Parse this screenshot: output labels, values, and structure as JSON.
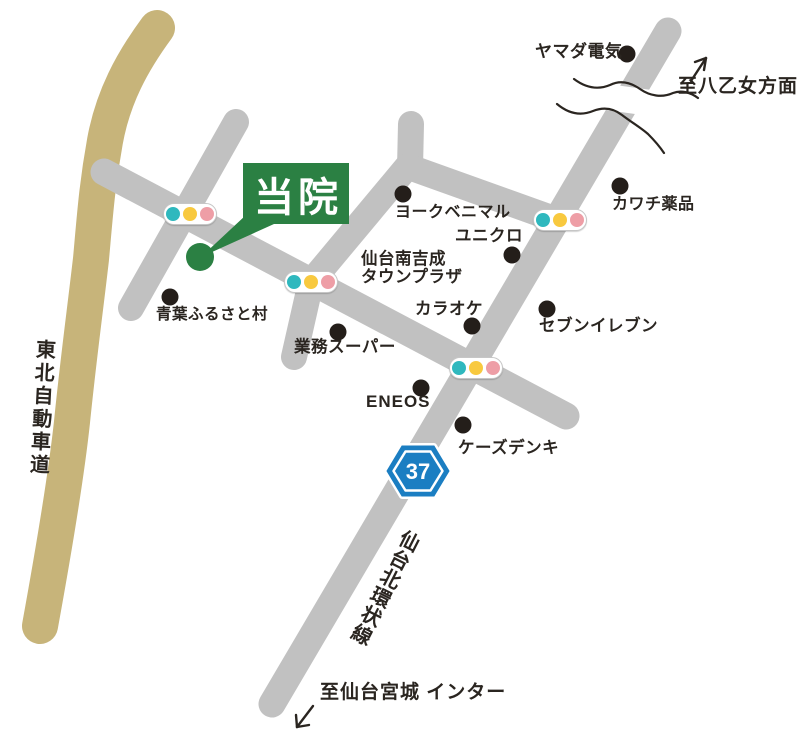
{
  "clinic": {
    "label": "当院"
  },
  "roads": {
    "expressway_label": "東北自動車道",
    "ring_road_label": "仙台北環状線"
  },
  "route_badge": {
    "number": "37"
  },
  "directions": {
    "north": "至八乙女方面",
    "south": "至仙台宮城 インター"
  },
  "landmarks": [
    {
      "id": "yamada-denki",
      "label": "ヤマダ電気"
    },
    {
      "id": "kawachi-yakuhin",
      "label": "カワチ薬品"
    },
    {
      "id": "york-benimaru",
      "label": "ヨークベニマル"
    },
    {
      "id": "uniqlo",
      "label": "ユニクロ"
    },
    {
      "id": "town-plaza",
      "label_line1": "仙台南吉成",
      "label_line2": "タウンプラザ"
    },
    {
      "id": "karaoke",
      "label": "カラオケ"
    },
    {
      "id": "seven-eleven",
      "label": "セブンイレブン"
    },
    {
      "id": "aoba-furusato-mura",
      "label": "青葉ふるさと村"
    },
    {
      "id": "gyomu-super",
      "label": "業務スーパー"
    },
    {
      "id": "eneos",
      "label": "ENEOS"
    },
    {
      "id": "ks-denki",
      "label": "ケーズデンキ"
    }
  ],
  "colors": {
    "road_gray": "#c1c1c1",
    "expressway_tan": "#c7b47a",
    "clinic_green": "#2b8043",
    "badge_blue": "#1b7ec2",
    "signal_green": "#2fb8be",
    "signal_yellow": "#f8c93f",
    "signal_red": "#ee9ea6",
    "landmark_dot": "#241e1a"
  }
}
